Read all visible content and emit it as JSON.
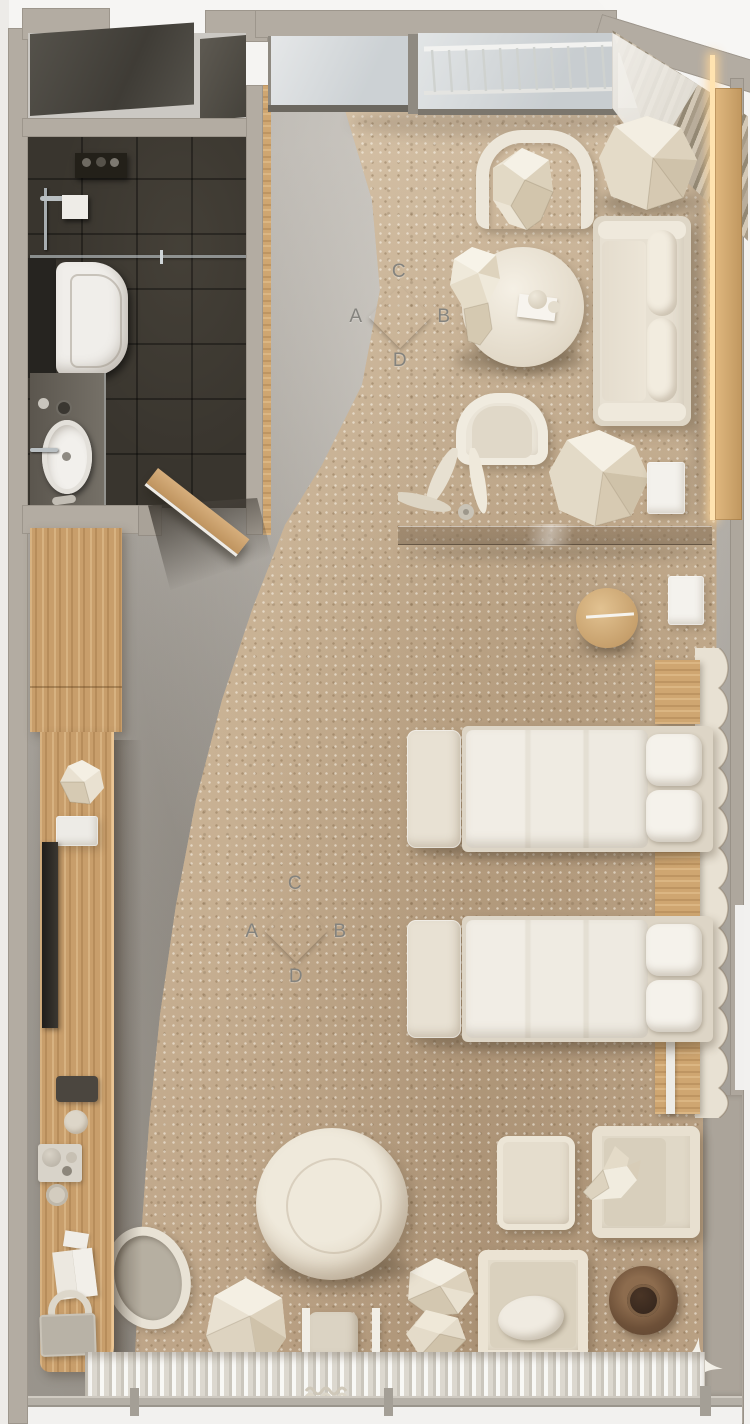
{
  "scene": {
    "title": "Hotel studio room floor plan — top-down 3D render",
    "view": "top-down"
  },
  "markers": [
    {
      "name": "camera-marker-living",
      "letters": {
        "top": "C",
        "left": "A",
        "right": "B",
        "bottom": "D"
      }
    },
    {
      "name": "camera-marker-bedroom",
      "letters": {
        "top": "C",
        "left": "A",
        "right": "B",
        "bottom": "D"
      }
    }
  ],
  "palette": {
    "wall": "#b3aca2",
    "concrete_floor": "#a8a39c",
    "carpet": "#ccb699",
    "wood": "#c89e6b",
    "furniture_cream": "#e8e1d3",
    "bathroom_dark": "#39352e",
    "led_light": "#ffdca5",
    "marker_letter": "#84837e",
    "dark_table": "#6d5038"
  },
  "rooms": {
    "bathroom": {
      "fixtures": [
        "walk-in-shower",
        "toilet",
        "vanity-sink",
        "mirror-cabinet",
        "glass-screen"
      ]
    },
    "living_area": {
      "furniture": [
        "sofa",
        "round-coffee-table",
        "curved-armchair",
        "curved-armchair-2",
        "faceted-boulder-1",
        "faceted-boulder-2",
        "leaf-sculpture",
        "white-side-table",
        "glass-partition"
      ]
    },
    "sleeping_area": {
      "furniture": [
        "single-bed-1",
        "single-bed-2",
        "bed-bench-1",
        "bed-bench-2",
        "round-wood-side-table",
        "white-nightstand",
        "wavy-headboard",
        "wood-nightstand-blocks"
      ]
    },
    "lounge_corner": {
      "furniture": [
        "armchair-with-ottoman",
        "armchair-with-pillow",
        "faceted-swan-sculpture",
        "round-dark-tray-table",
        "large-round-pouf",
        "faceted-stool",
        "chair",
        "faceted-rocks",
        "sparkle-decal"
      ]
    },
    "entry_wall": {
      "furniture": [
        "entrance-door",
        "wardrobe",
        "media-console",
        "tv",
        "desk-accessories",
        "oval-pouf"
      ]
    },
    "windows": {
      "items": [
        "fixed-window",
        "french-balcony-railing",
        "corner-curtains",
        "led-cove-light",
        "bottom-window-wall",
        "sheer-curtain"
      ]
    }
  }
}
